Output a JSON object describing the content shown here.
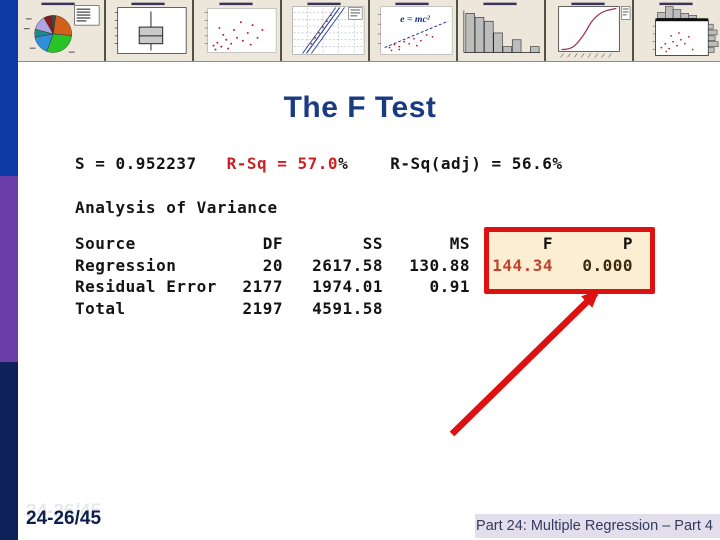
{
  "slide": {
    "title": "The F Test",
    "stats_line": {
      "s": "S = 0.952237",
      "rsq_red": "R-Sq = 57.0",
      "rsq_pct": "%",
      "rsq_adj": "R-Sq(adj) = 56.6%"
    },
    "section_heading": "Analysis of Variance",
    "anova_table": {
      "columns": [
        "Source",
        "DF",
        "SS",
        "MS",
        "F",
        "P"
      ],
      "rows": [
        {
          "source": "Regression",
          "df": "20",
          "ss": "2617.58",
          "ms": "130.88",
          "f": "144.34",
          "p": "0.000"
        },
        {
          "source": "Residual Error",
          "df": "2177",
          "ss": "1974.01",
          "ms": "0.91",
          "f": "",
          "p": ""
        },
        {
          "source": "Total",
          "df": "2197",
          "ss": "4591.58",
          "ms": "",
          "f": "",
          "p": ""
        }
      ]
    },
    "highlight": {
      "f_value": "144.34",
      "p_value": "0.000"
    }
  },
  "banner": {
    "thumbnails": [
      {
        "name": "pie-chart-thumbnail"
      },
      {
        "name": "boxplot-thumbnail"
      },
      {
        "name": "scatter-plot-thumbnail"
      },
      {
        "name": "regression-fit-lines-thumbnail"
      },
      {
        "name": "equation-scatter-thumbnail",
        "formula": "e = mc²"
      },
      {
        "name": "histogram-thumbnail"
      },
      {
        "name": "s-curve-thumbnail"
      },
      {
        "name": "marginal-plot-thumbnail"
      }
    ]
  },
  "footer": {
    "slide_number": "24-26/45",
    "caption": "Part 24: Multiple Regression – Part 4"
  },
  "colors": {
    "accent_red": "#dd1111",
    "title_blue": "#1a3b82",
    "stats_red": "#cc2222",
    "f_value_red": "#c2432e",
    "p_value_brown": "#3d2b0e",
    "highlight_fill": "#fbeed2",
    "bar_blue": "#0c3aa4",
    "bar_purple": "#6a3da8",
    "bar_navy": "#0e2159",
    "banner_beige": "#ece7da",
    "footer_strip": "#e2deeb"
  }
}
